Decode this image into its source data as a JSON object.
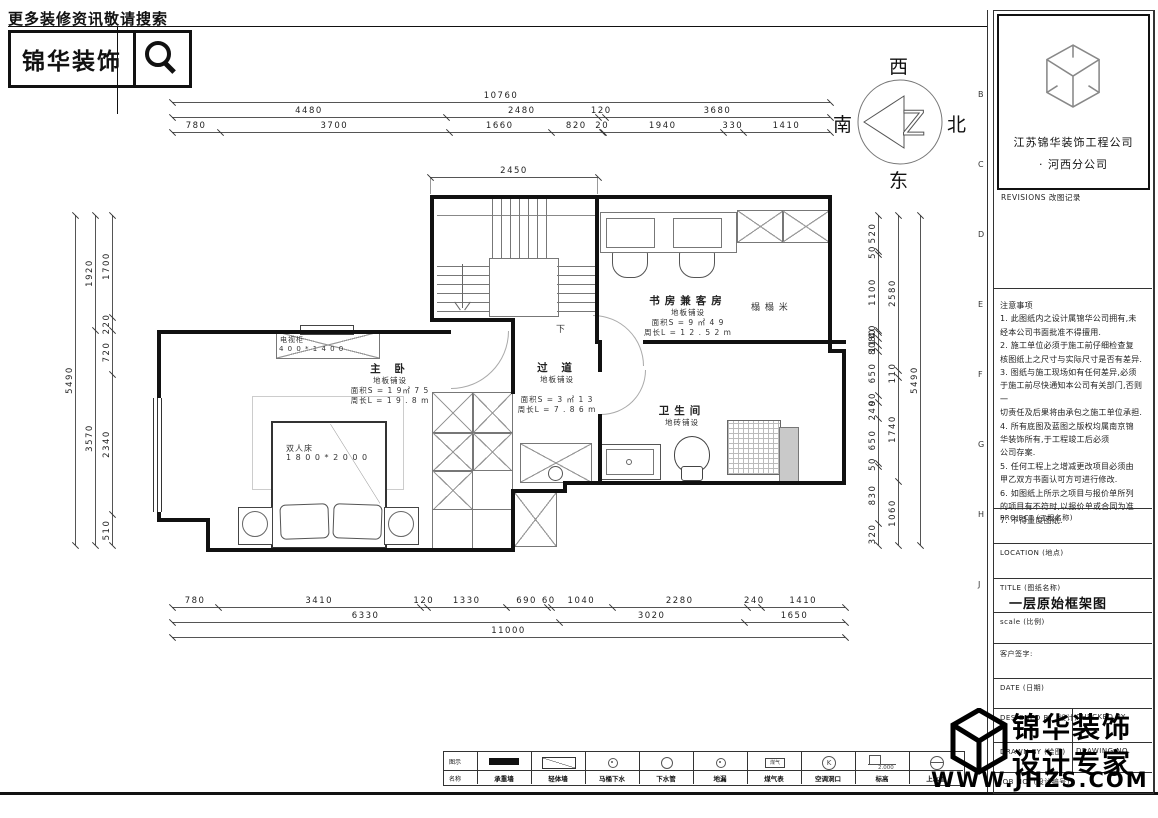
{
  "header": {
    "tagline": "更多装修资讯敬请搜索",
    "brand": "锦华装饰"
  },
  "compass": {
    "top": "西",
    "right": "北",
    "bottom": "东",
    "left": "南"
  },
  "title_block": {
    "company": "江苏锦华装饰工程公司",
    "branch": "·  河西分公司",
    "revisions_title": "REVISIONS 改图记录",
    "revisions_cols": [
      "NO. 编号",
      "DATE 日期",
      "REMARKS 备注"
    ],
    "notes": [
      "注意事项",
      "  1. 此图纸内之设计属锦华公司拥有,未",
      "经本公司书面批准不得擅用.",
      "  2.  施工单位必须于施工前仔细检查复",
      "核图纸上之尺寸与实际尺寸是否有差异.",
      "  3.  图纸与施工现场如有任何差异,必须",
      "于施工前尽快通知本公司有关部门,否则一",
      "切责任及后果将由承包之施工单位承担.",
      "  4.  所有底图及蓝图之版权均属南京锦",
      "华装饰所有,于工程竣工后必须",
      "公司存案.",
      "  5.  任何工程上之增减更改项目必须由",
      "甲乙双方书面认可方可进行修改.",
      "  6.  如图纸上所示之项目与报价单所列",
      "的项目有不符时,以报价单或合同为准.",
      "  7.  不得量度图纸."
    ],
    "project_label": "PROJECT (工程名称)",
    "location_label": "LOCATION (地点)",
    "title_label": "TITLE (图纸名称)",
    "title_value": "一层原始框架图",
    "scale_label": "scale  (比例)",
    "client_label": "客户签字:",
    "date_label": "DATE (日期)",
    "designed_label": "DESIGNED BY (设计)",
    "checked_label": "CHECKED BY",
    "drawn_label": "DRAWN BY (绘图)",
    "drawing_no_label": "DRAWING NO.",
    "job_no_label": "JOB NO. (设计编号)",
    "zone_letters": [
      "B",
      "C",
      "D",
      "E",
      "F",
      "G",
      "H",
      "J"
    ]
  },
  "watermark": {
    "line1": "锦华装饰",
    "line2": "设计专家",
    "url": "WWW.JHZS.COM"
  },
  "legend": {
    "row1_label": "图示",
    "row2_label": "名称",
    "elevation_value": "2.000",
    "items": [
      {
        "symbol": "wall-solid",
        "name": "承重墙"
      },
      {
        "symbol": "wall-diag",
        "name": "轻体墙"
      },
      {
        "symbol": "drain-small",
        "name": "马桶下水"
      },
      {
        "symbol": "circle",
        "name": "下水管"
      },
      {
        "symbol": "floor-drain",
        "name": "地漏"
      },
      {
        "symbol": "meter-box",
        "name": "煤气表"
      },
      {
        "symbol": "circle-k",
        "name": "空调洞口"
      },
      {
        "symbol": "elevation",
        "name": "标高"
      },
      {
        "symbol": "water-pipe",
        "name": "上水管"
      }
    ]
  },
  "plan": {
    "rooms": [
      {
        "name": "主  卧",
        "cx": 390,
        "y": 361,
        "lines": [
          "地板铺设",
          "面积S = 1 9㎡ 7 5",
          "周长L = 1 9 . 8 m"
        ]
      },
      {
        "name": "过  道",
        "cx": 557,
        "y": 360,
        "lines": [
          "地板铺设",
          "",
          "面积S = 3 ㎡ 1 3",
          "周长L = 7 . 8 6 m"
        ]
      },
      {
        "name": "书房兼客房",
        "cx": 688,
        "y": 293,
        "lines": [
          "地板铺设",
          "面积S = 9 ㎡ 4 9",
          "周长L = 1 2 . 5 2 m"
        ]
      },
      {
        "name": "卫生间",
        "cx": 682,
        "y": 403,
        "lines": [
          "地砖铺设"
        ]
      }
    ],
    "furniture_labels": [
      {
        "text": "电视柜",
        "x": 280,
        "y": 335,
        "size": 7
      },
      {
        "text": "4 0 0 * 1 4 0 0",
        "x": 279,
        "y": 345,
        "size": 7
      },
      {
        "text": "双人床",
        "x": 286,
        "y": 443,
        "size": 8
      },
      {
        "text": "1 8 0 0 * 2 0 0 0",
        "x": 286,
        "y": 453,
        "size": 8
      },
      {
        "text": "榻  榻  米",
        "x": 751,
        "y": 300,
        "size": 9
      },
      {
        "text": "下",
        "x": 556,
        "y": 322,
        "size": 9
      }
    ],
    "dims": {
      "top": {
        "x1": 172,
        "x2": 830,
        "rows": [
          {
            "y": 102,
            "vals": [
              "10760"
            ]
          },
          {
            "y": 117,
            "vals": [
              "4480",
              "2480",
              "120",
              "3680"
            ]
          },
          {
            "y": 132,
            "vals": [
              "780",
              "3700",
              "1660",
              "820",
              "20",
              "1940",
              "330",
              "1410"
            ]
          }
        ]
      },
      "mid": {
        "x1": 430,
        "x2": 598,
        "rows": [
          {
            "y": 177,
            "vals": [
              "2450"
            ]
          }
        ]
      },
      "bottom": {
        "x1": 172,
        "x2": 845,
        "rows": [
          {
            "y": 607,
            "vals": [
              "780",
              "3410",
              "120",
              "1330",
              "690",
              "60",
              "1040",
              "2280",
              "240",
              "1410"
            ]
          },
          {
            "y": 622,
            "vals": [
              "6330",
              "3020",
              "1650"
            ]
          },
          {
            "y": 637,
            "vals": [
              "11000"
            ]
          }
        ]
      },
      "left": {
        "y1": 215,
        "y2": 545,
        "cols": [
          {
            "x": 75,
            "vals": [
              "5490"
            ]
          },
          {
            "x": 95,
            "vals": [
              "1920",
              "3570"
            ]
          },
          {
            "x": 112,
            "vals": [
              "1700",
              "220",
              "720",
              "2340",
              "510"
            ]
          }
        ]
      },
      "right": {
        "y1": 215,
        "y2": 545,
        "cols": [
          {
            "x": 920,
            "vals": [
              "5490"
            ]
          },
          {
            "x": 898,
            "vals": [
              "2580",
              "110",
              "1740",
              "1060"
            ]
          },
          {
            "x": 878,
            "vals": [
              "520",
              "50",
              "1100",
              "40",
              "80",
              "110",
              "80",
              "650",
              "90",
              "240",
              "650",
              "50",
              "830",
              "320"
            ]
          }
        ]
      }
    },
    "geometry": {
      "walls": [
        [
          430,
          195,
          401,
          4
        ],
        [
          828,
          195,
          4,
          158
        ],
        [
          828,
          349,
          18,
          4
        ],
        [
          842,
          349,
          4,
          136
        ],
        [
          563,
          481,
          283,
          4
        ],
        [
          563,
          481,
          4,
          12
        ],
        [
          511,
          489,
          56,
          4
        ],
        [
          511,
          489,
          4,
          63
        ],
        [
          206,
          548,
          309,
          4
        ],
        [
          206,
          518,
          4,
          34
        ],
        [
          157,
          518,
          53,
          4
        ],
        [
          157,
          330,
          4,
          192
        ],
        [
          157,
          330,
          294,
          4
        ],
        [
          430,
          195,
          4,
          127
        ],
        [
          595,
          195,
          4,
          149
        ],
        [
          643,
          340,
          203,
          4
        ],
        [
          598,
          340,
          4,
          32
        ],
        [
          598,
          414,
          4,
          70
        ],
        [
          430,
          318,
          85,
          4
        ],
        [
          511,
          318,
          4,
          76
        ]
      ],
      "xboxes": [
        [
          432,
          392,
          40,
          40
        ],
        [
          472,
          392,
          39,
          40
        ],
        [
          432,
          432,
          40,
          38
        ],
        [
          472,
          432,
          39,
          38
        ],
        [
          432,
          470,
          40,
          39
        ],
        [
          514,
          492,
          41,
          53
        ],
        [
          737,
          210,
          45,
          31
        ],
        [
          782,
          210,
          46,
          31
        ],
        [
          520,
          443,
          70,
          38
        ]
      ],
      "pboxes": [
        [
          472,
          470,
          39,
          39
        ],
        [
          432,
          509,
          40,
          39
        ],
        [
          472,
          509,
          39,
          39
        ],
        [
          489,
          258,
          68,
          57
        ],
        [
          600,
          212,
          135,
          39
        ],
        [
          606,
          218,
          47,
          28
        ],
        [
          673,
          218,
          47,
          28
        ]
      ],
      "stairs": {
        "top_line": [
          437,
          215,
          158
        ],
        "vlines_x": [
          492,
          501,
          510,
          519,
          528,
          537,
          546
        ],
        "v_y1": 199,
        "v_len": 59,
        "hlines_y": [
          266,
          275,
          284,
          293,
          302,
          311
        ],
        "left_x": 437,
        "left_len": 52,
        "right_x": 557,
        "right_len": 38,
        "arrow": [
          462,
          264,
          44
        ]
      }
    }
  }
}
